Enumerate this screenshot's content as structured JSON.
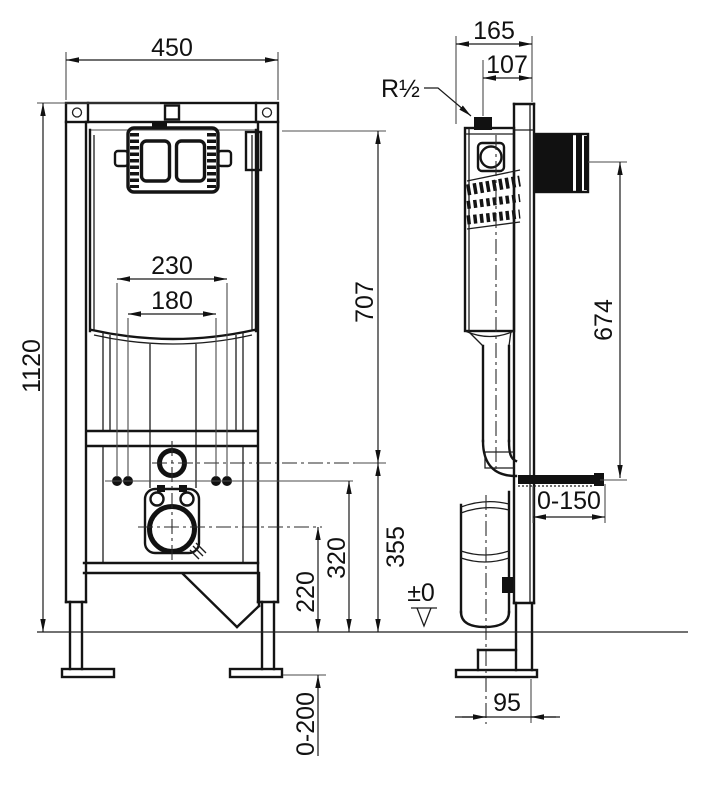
{
  "front_view": {
    "dims": {
      "frame_width": "450",
      "frame_height": "1120",
      "anchor_spacing": "230",
      "fixing_bolt_spacing": "180",
      "flush_pipe_center_height": "707",
      "flush_bend_height": "355",
      "fixing_bolt_height": "320",
      "outlet_center_height": "220",
      "foot_adjustment_range": "0-200"
    }
  },
  "side_view": {
    "dims": {
      "frame_depth": "165",
      "water_connection_offset": "107",
      "water_connection_size": "R½",
      "wall_bracket_height": "674",
      "fixing_rod_range": "0-150",
      "floor_level": "±0",
      "outlet_center_offset": "95"
    }
  }
}
